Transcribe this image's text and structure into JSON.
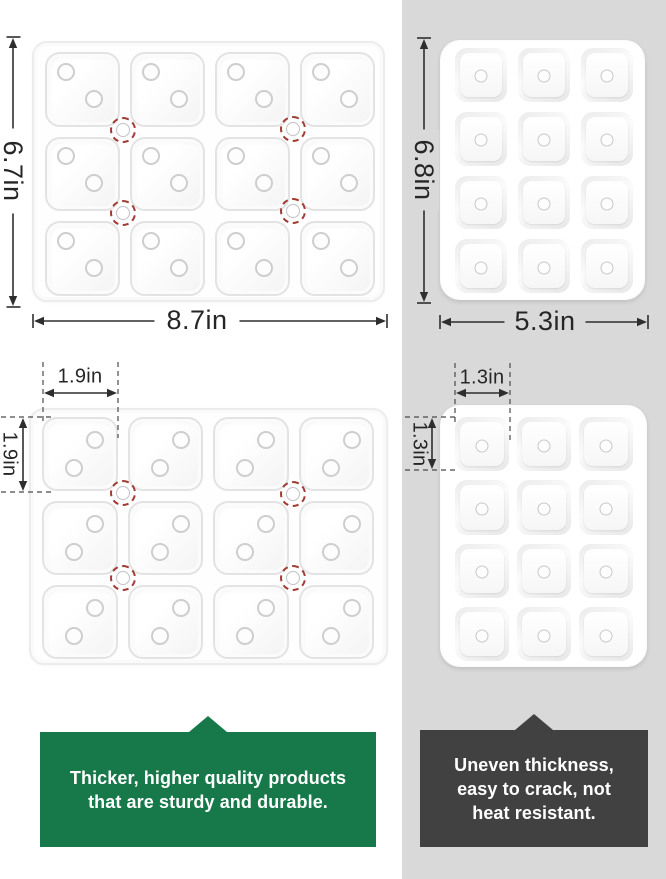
{
  "meta": {
    "type": "product-comparison-infographic"
  },
  "colors": {
    "competitor_panel_bg": "#d9d9d9",
    "good_callout_bg": "#17794a",
    "bad_callout_bg": "#414141",
    "highlight_ring_red": "#a23b32",
    "dimension_ink": "#2e2e2e"
  },
  "icons": {
    "vent_hole": "circle-outline",
    "highlight_ring": "red-dashed-circle"
  },
  "good_product": {
    "overall_width_label": "8.7in",
    "overall_height_label": "6.7in",
    "cell_width_label": "1.9in",
    "cell_height_label": "1.9in",
    "grid": {
      "cols": 4,
      "rows": 3,
      "compartments": 12
    },
    "callout_lines": [
      "Thicker, higher quality products",
      "that are sturdy and durable."
    ]
  },
  "bad_product": {
    "overall_width_label": "5.3in",
    "overall_height_label": "6.8in",
    "cell_width_label": "1.3in",
    "cell_height_label": "1.3in",
    "grid": {
      "cols": 3,
      "rows": 4,
      "compartments": 12
    },
    "callout_lines": [
      "Uneven thickness,",
      "easy to crack, not",
      "heat resistant."
    ]
  }
}
